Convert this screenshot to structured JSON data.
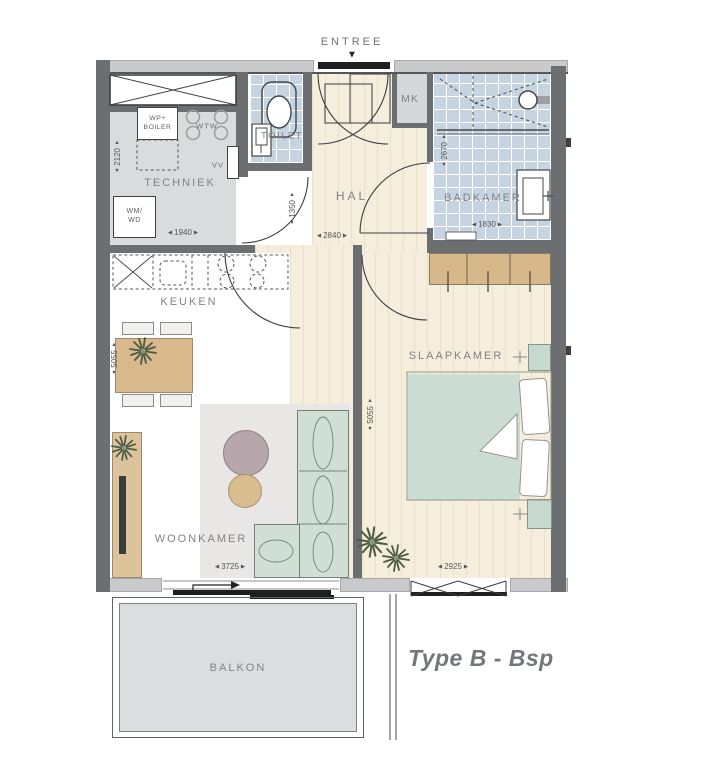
{
  "labels": {
    "entree": "ENTREE",
    "techniek": "TECHNIEK",
    "toilet": "TOILET",
    "hal": "HAL",
    "mk": "MK",
    "badkamer": "BADKAMER",
    "keuken": "KEUKEN",
    "woonkamer": "WOONKAMER",
    "slaapkamer": "SLAAPKAMER",
    "balkon": "BALKON",
    "plan_type": "Type B - Bsp",
    "wp_boiler_line1": "WP+",
    "wp_boiler_line2": "BOILER",
    "wtw": "WTW",
    "vv": "VV",
    "wm_line1": "WM/",
    "wm_line2": "WD"
  },
  "dimensions": {
    "techniek_height": "2120",
    "techniek_width": "1940",
    "hal_nook_height": "1350",
    "hal_width": "2840",
    "badkamer_height": "2670",
    "badkamer_width": "1830",
    "living_height": "5055",
    "bedroom_height": "5055",
    "woonkamer_width": "3725",
    "slaapkamer_width": "2925"
  },
  "ui": {
    "left": "◀",
    "right": "▶",
    "up": "▲",
    "down": "▼",
    "entry_marker": "▼"
  },
  "colors": {
    "wall": "#6c6f72",
    "exterior_band": "#c9cacb",
    "bathroom_tile": "#c5d4e0",
    "wood_floor": "#f6eedd",
    "techniek_floor": "#dadbdc",
    "balcony": "#dcdddf",
    "furniture_tan": "#d6b88b",
    "furniture_green": "#cdddd3",
    "label_text": "#7f8386"
  }
}
